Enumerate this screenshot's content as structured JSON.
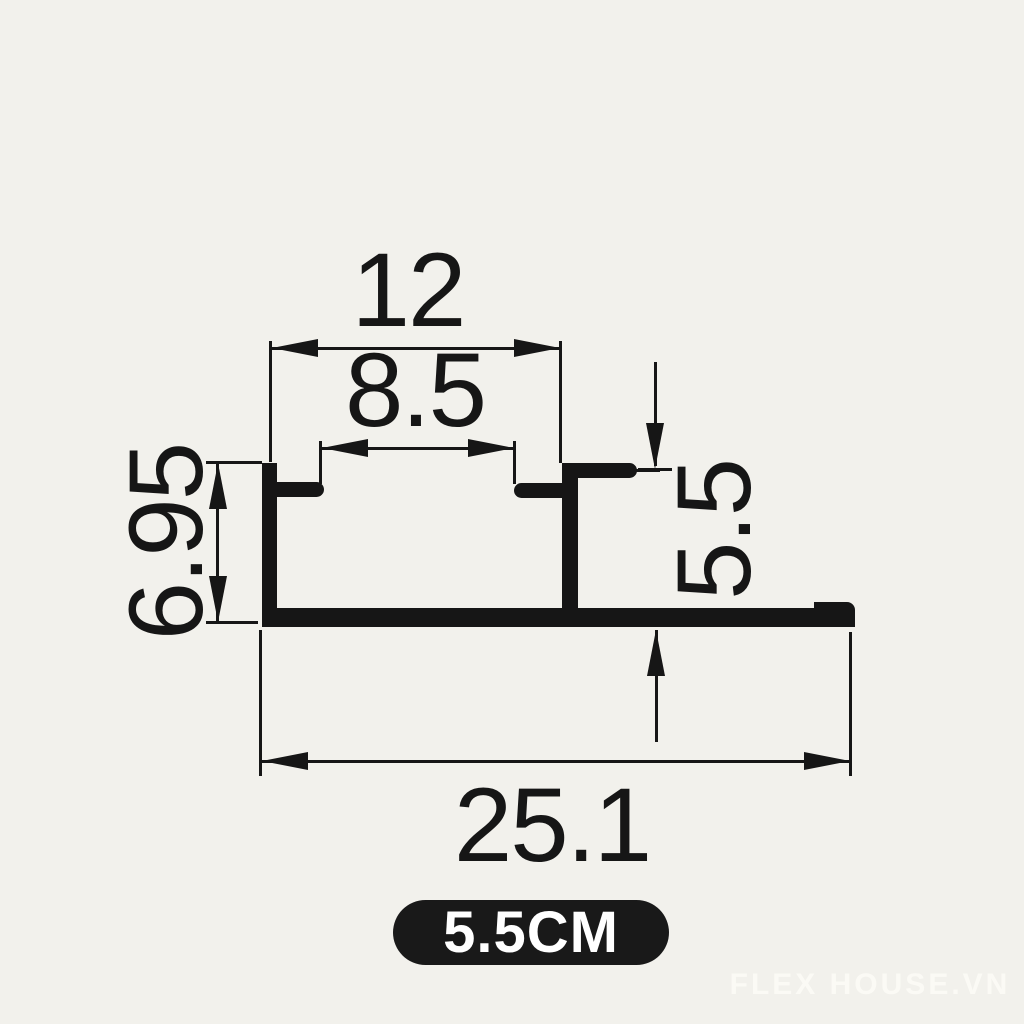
{
  "colors": {
    "background": "#f2f1ec",
    "ink": "#161616",
    "badge_bg": "#191919",
    "badge_text": "#ffffff",
    "watermark": "#fbfaf5"
  },
  "drawing": {
    "type": "technical-profile-cross-section",
    "dimensions": {
      "top_width": "12",
      "slot_width": "8.5",
      "left_height": "6.95",
      "right_height": "5.5",
      "overall_width": "25.1"
    }
  },
  "badge": {
    "label": "5.5CM"
  },
  "watermark": {
    "text": "FLEX HOUSE.VN"
  }
}
